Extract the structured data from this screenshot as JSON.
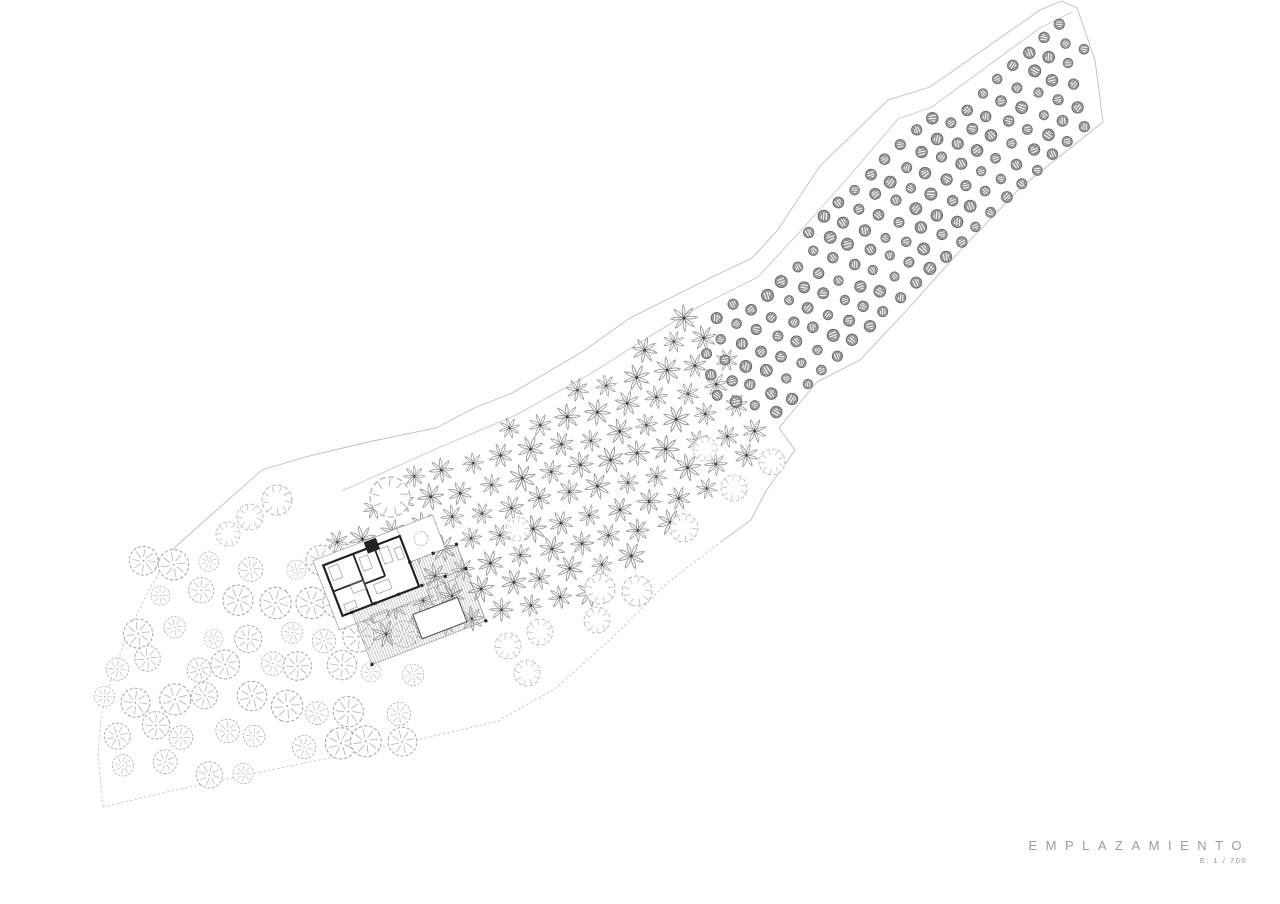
{
  "title": {
    "label": "EMPLAZAMIENTO",
    "scale_label": "E: 1 / 700"
  },
  "colors": {
    "boundary": "#bdbdbd",
    "boundary_dashed": "#c4c4c4",
    "road_inner": "#c6c6c6",
    "star_stroke": "#8f8f8f",
    "star_center": "#3c3c3c",
    "dark_fill": "#959595",
    "dark_stroke": "#606060",
    "dark_slash": "#f4f4f4",
    "grove_stroke": "#a3a3a3",
    "grove_spoke": "#aeaeae",
    "medium_stroke": "#b6b6b6",
    "wall": "#222222",
    "thin_outline": "#9a9a9a",
    "deck_line": "#a5a5a5",
    "furniture": "#8a8a8a",
    "pool_stroke": "#555555"
  },
  "site": {
    "paths": [
      {
        "name": "boundary-top",
        "dashed": false,
        "points": [
          [
            173,
            549
          ],
          [
            210,
            516
          ],
          [
            262,
            470
          ],
          [
            305,
            457
          ],
          [
            368,
            442
          ],
          [
            436,
            428
          ],
          [
            472,
            409
          ],
          [
            512,
            393
          ],
          [
            582,
            352
          ],
          [
            630,
            318
          ],
          [
            672,
            297
          ],
          [
            712,
            277
          ],
          [
            752,
            258
          ],
          [
            777,
            231
          ],
          [
            820,
            166
          ],
          [
            888,
            100
          ],
          [
            930,
            87
          ],
          [
            990,
            45
          ],
          [
            1040,
            10
          ],
          [
            1062,
            1
          ],
          [
            1077,
            8
          ]
        ]
      },
      {
        "name": "boundary-right",
        "dashed": false,
        "points": [
          [
            1077,
            8
          ],
          [
            1095,
            60
          ],
          [
            1103,
            122
          ],
          [
            1020,
            188
          ],
          [
            958,
            253
          ],
          [
            906,
            311
          ],
          [
            860,
            360
          ],
          [
            817,
            382
          ],
          [
            779,
            428
          ],
          [
            795,
            450
          ],
          [
            766,
            491
          ],
          [
            751,
            520
          ],
          [
            722,
            541
          ]
        ]
      },
      {
        "name": "boundary-bottom",
        "dashed": true,
        "points": [
          [
            722,
            541
          ],
          [
            666,
            584
          ],
          [
            612,
            638
          ],
          [
            556,
            688
          ],
          [
            498,
            721
          ],
          [
            430,
            737
          ],
          [
            300,
            764
          ],
          [
            180,
            789
          ],
          [
            103,
            807
          ]
        ]
      },
      {
        "name": "boundary-left",
        "dashed": true,
        "points": [
          [
            103,
            807
          ],
          [
            98,
            755
          ],
          [
            101,
            716
          ],
          [
            112,
            676
          ],
          [
            128,
            632
          ],
          [
            150,
            588
          ],
          [
            173,
            549
          ]
        ]
      },
      {
        "name": "access-road-inner-edge",
        "dashed": false,
        "points": [
          [
            342,
            491
          ],
          [
            400,
            465
          ],
          [
            438,
            448
          ],
          [
            516,
            415
          ],
          [
            590,
            374
          ],
          [
            655,
            333
          ],
          [
            700,
            306
          ],
          [
            758,
            277
          ],
          [
            806,
            225
          ],
          [
            852,
            173
          ],
          [
            898,
            119
          ],
          [
            932,
            107
          ],
          [
            1000,
            57
          ],
          [
            1040,
            28
          ],
          [
            1072,
            12
          ]
        ]
      }
    ]
  },
  "orchards": [
    {
      "name": "star-orchard",
      "symbol": "star",
      "angle": -12,
      "col": 30,
      "row": 25,
      "jitter": 2.2,
      "r": 12,
      "rv": 1.6,
      "seed": 7,
      "clip": [
        [
          465,
          452
        ],
        [
          514,
          421
        ],
        [
          590,
          379
        ],
        [
          658,
          334
        ],
        [
          703,
          303
        ],
        [
          770,
          440
        ],
        [
          716,
          496
        ],
        [
          650,
          550
        ],
        [
          597,
          590
        ],
        [
          528,
          622
        ],
        [
          465,
          636
        ],
        [
          400,
          642
        ],
        [
          342,
          622
        ],
        [
          330,
          548
        ],
        [
          398,
          468
        ]
      ]
    },
    {
      "name": "dense-orchard",
      "symbol": "dark",
      "angle": -43,
      "col": 21,
      "row": 18.5,
      "jitter": 1.6,
      "r": 5.4,
      "rv": 0.7,
      "seed": 3,
      "clip": [
        [
          704,
          398
        ],
        [
          706,
          312
        ],
        [
          760,
          286
        ],
        [
          808,
          232
        ],
        [
          854,
          180
        ],
        [
          900,
          126
        ],
        [
          934,
          114
        ],
        [
          1000,
          64
        ],
        [
          1062,
          22
        ],
        [
          1082,
          32
        ],
        [
          1096,
          118
        ],
        [
          1018,
          194
        ],
        [
          958,
          255
        ],
        [
          905,
          312
        ],
        [
          860,
          358
        ],
        [
          818,
          380
        ],
        [
          782,
          422
        ]
      ]
    }
  ],
  "grove": {
    "name": "tree-grove",
    "symbol": "grove",
    "angle": 3,
    "col": 37,
    "row": 35,
    "jitter": 8,
    "r": 12.5,
    "rv": 3.2,
    "seed": 11,
    "clip": [
      [
        130,
        562
      ],
      [
        235,
        545
      ],
      [
        322,
        548
      ],
      [
        362,
        592
      ],
      [
        432,
        650
      ],
      [
        428,
        700
      ],
      [
        400,
        735
      ],
      [
        412,
        755
      ],
      [
        350,
        765
      ],
      [
        255,
        777
      ],
      [
        170,
        791
      ],
      [
        110,
        793
      ],
      [
        99,
        735
      ],
      [
        105,
        682
      ],
      [
        120,
        638
      ],
      [
        143,
        594
      ]
    ]
  },
  "medium_trees": [
    [
      277,
      500,
      15
    ],
    [
      250,
      517,
      13
    ],
    [
      228,
      534,
      12
    ],
    [
      390,
      497,
      20
    ],
    [
      518,
      529,
      12
    ],
    [
      684,
      528,
      14
    ],
    [
      705,
      449,
      12
    ],
    [
      772,
      462,
      13
    ],
    [
      734,
      488,
      13
    ],
    [
      600,
      589,
      15
    ],
    [
      637,
      591,
      15
    ],
    [
      597,
      620,
      13
    ],
    [
      508,
      646,
      13
    ],
    [
      540,
      632,
      13
    ],
    [
      527,
      673,
      13
    ]
  ],
  "building": {
    "cx": 395,
    "cy": 585,
    "angle": -21,
    "thin_rects": [
      [
        -68,
        -52,
        98,
        74
      ],
      [
        22,
        -52,
        38,
        36
      ]
    ],
    "deck_rects": [
      [
        -50,
        10,
        122,
        56
      ],
      [
        22,
        -16,
        50,
        26
      ]
    ],
    "pool": [
      6,
      34,
      48,
      26
    ],
    "wall_rects": [
      [
        -60,
        -44,
        82,
        54
      ]
    ],
    "partitions": [
      [
        -28,
        -44,
        -28,
        10
      ],
      [
        -60,
        -16,
        -28,
        -16
      ],
      [
        -6,
        -44,
        -6,
        -12
      ],
      [
        -28,
        -12,
        -6,
        -12
      ]
    ],
    "solid_rects": [
      [
        -14,
        -51,
        13,
        12
      ]
    ],
    "columns": [
      [
        -50,
        10
      ],
      [
        -25,
        10
      ],
      [
        0,
        10
      ],
      [
        25,
        10
      ],
      [
        50,
        10
      ],
      [
        72,
        10
      ],
      [
        72,
        -16
      ],
      [
        47,
        -16
      ],
      [
        22,
        -16
      ],
      [
        72,
        66
      ],
      [
        -50,
        66
      ]
    ],
    "furniture": [
      [
        -56,
        -40,
        10,
        14
      ],
      [
        -42,
        -16,
        14,
        9
      ],
      [
        -24,
        -38,
        9,
        14
      ],
      [
        -2,
        -39,
        9,
        16
      ],
      [
        12,
        -34,
        7,
        12
      ],
      [
        -55,
        0,
        12,
        7
      ],
      [
        -20,
        -8,
        16,
        10
      ],
      [
        28,
        16,
        8,
        13
      ],
      [
        39,
        16,
        8,
        13
      ],
      [
        50,
        16,
        8,
        13
      ],
      [
        -34,
        20,
        18,
        8
      ]
    ],
    "court_tree": [
      41,
      -34,
      7
    ]
  }
}
